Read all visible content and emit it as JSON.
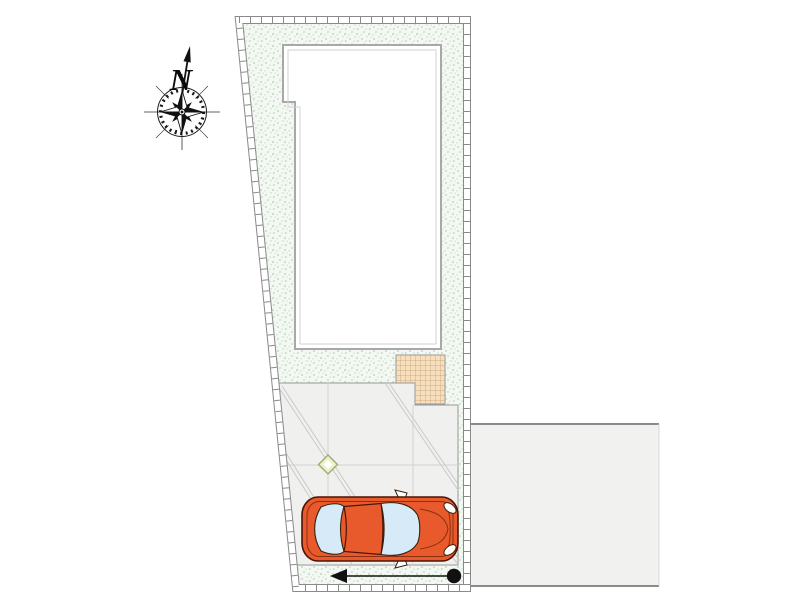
{
  "plan": {
    "title": "residential-site-plan",
    "compass": {
      "label": "N"
    },
    "features": [
      "plot-boundary-wall",
      "lawn",
      "building-footprint",
      "terrace-tile",
      "driveway-paving",
      "paving-joints",
      "survey-diamond-marker",
      "car-top-view",
      "neighbor-lot",
      "entry-arrow",
      "entry-point-dot",
      "compass-rose",
      "north-arrow"
    ],
    "colors": {
      "lawn_background": "#f3f8f2",
      "lawn_stipple": "#cfe2cf",
      "boundary_line": "#8a8a8a",
      "building_fill": "#ffffff",
      "building_outline": "#a8a8a8",
      "terrace_fill": "#f6dfbe",
      "terrace_grid": "#c49a6c",
      "driveway_fill": "#f0f0ee",
      "driveway_joint": "#c9c9c9",
      "marker_fill": "#eef0cd",
      "marker_stroke": "#9aa86a",
      "car_body": "#e85a2c",
      "car_outline": "#4a1405",
      "car_window": "#d6eaf8",
      "neighbor_fill": "#f1f1f0",
      "arrow_color": "#111111"
    }
  }
}
